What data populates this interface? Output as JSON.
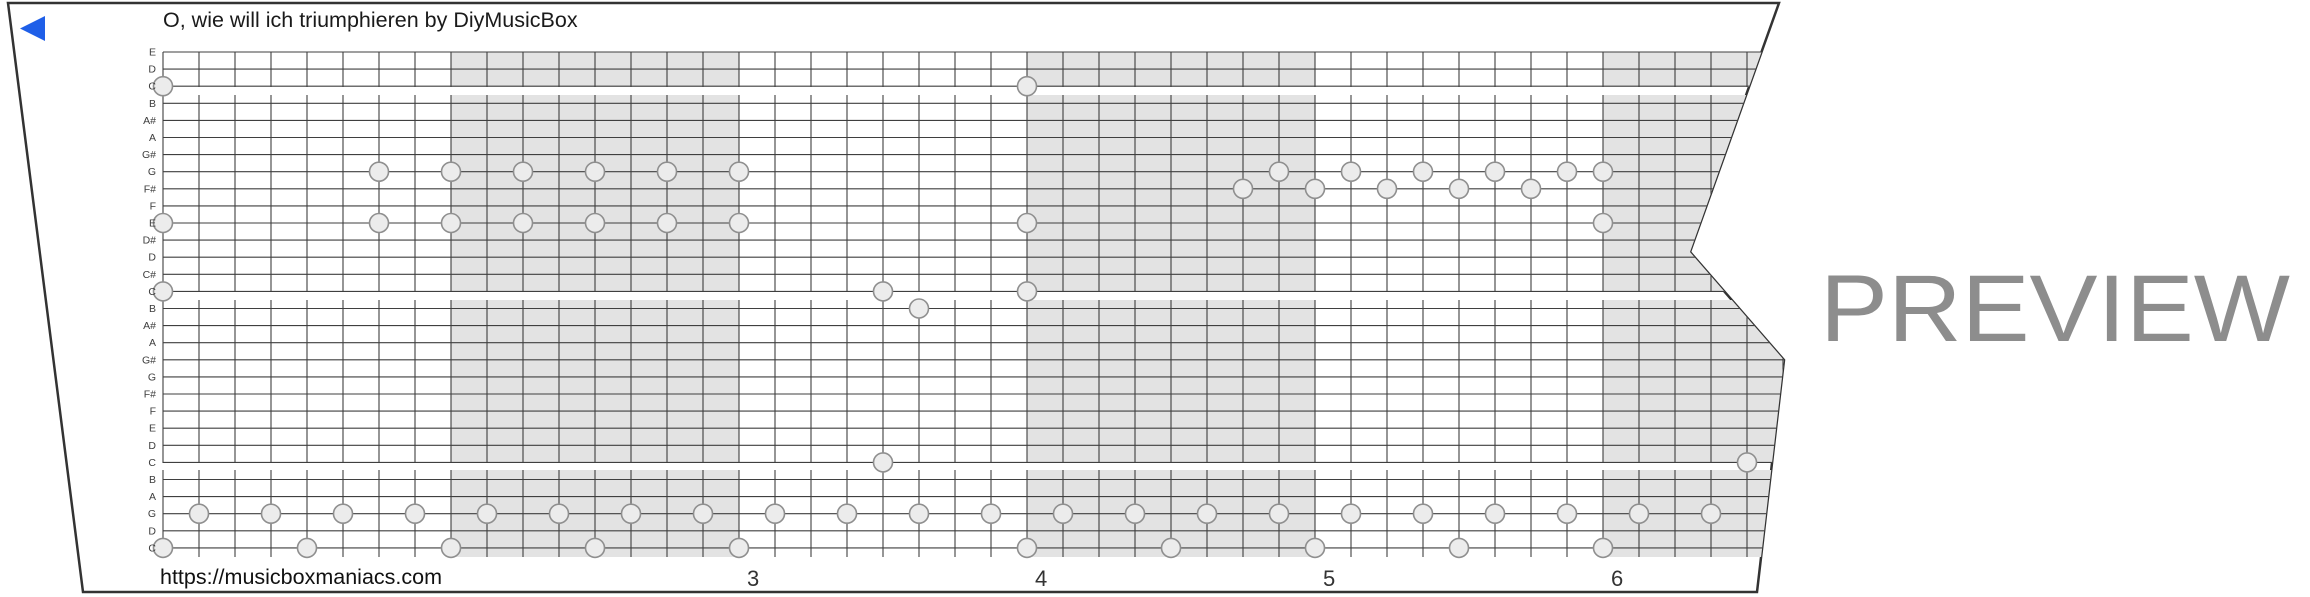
{
  "title": "O, wie will ich triumphieren by DiyMusicBox",
  "watermark": "PREVIEW",
  "footer_url": "https://musicboxmaniacs.com",
  "colors": {
    "background": "#ffffff",
    "strip_fill": "#ffffff",
    "strip_border": "#333333",
    "grid_line": "#3f3f3f",
    "measure_shade": "#e3e3e3",
    "note_fill": "#ececec",
    "note_stroke": "#8f8f8f",
    "label_text": "#3d3d3d",
    "number_text": "#333333",
    "title_text": "#1a1a1a",
    "url_text": "#111111",
    "watermark_text": "#8d8d8d",
    "play_arrow": "#1f5fe8"
  },
  "strip_outline": [
    [
      8,
      3
    ],
    [
      1779,
      3
    ],
    [
      1690,
      252
    ],
    [
      1784,
      360
    ],
    [
      1757,
      592
    ],
    [
      83,
      592
    ]
  ],
  "play_arrow_points": [
    [
      45,
      16
    ],
    [
      45,
      41
    ],
    [
      20,
      28.5
    ]
  ],
  "grid": {
    "x0": 163,
    "beat_width": 36,
    "row0_y": 52,
    "row_height": 17.1,
    "num_rows": 30,
    "num_beats": 46,
    "right_extent": 1800,
    "bands": [
      [
        52,
        87
      ],
      [
        95,
        292
      ],
      [
        300,
        463
      ],
      [
        470,
        557
      ]
    ],
    "row_labels": [
      "E",
      "D",
      "C",
      "B",
      "A#",
      "A",
      "G#",
      "G",
      "F#",
      "F",
      "E",
      "D#",
      "D",
      "C#",
      "C",
      "B",
      "A#",
      "A",
      "G#",
      "G",
      "F#",
      "F",
      "E",
      "D",
      "C",
      "B",
      "A",
      "G",
      "D",
      "C"
    ],
    "label_x": 156,
    "label_size": 10.5
  },
  "measures": {
    "beats_per_measure": 8,
    "shaded_measures": [
      2,
      4,
      6
    ],
    "numbers": [
      {
        "label": "3",
        "measure": 3
      },
      {
        "label": "4",
        "measure": 4
      },
      {
        "label": "5",
        "measure": 5
      },
      {
        "label": "6",
        "measure": 6
      }
    ],
    "number_y": 586,
    "number_size": 22,
    "number_x_offset": 8
  },
  "notes": [
    {
      "pitch": "C",
      "row": 3,
      "beats": [
        0,
        24
      ]
    },
    {
      "pitch": "G",
      "row": 8,
      "beats": [
        6,
        8,
        10,
        12,
        14,
        16,
        31,
        33,
        35,
        37,
        39,
        40
      ]
    },
    {
      "pitch": "F#",
      "row": 9,
      "beats": [
        30,
        32,
        34,
        36,
        38
      ]
    },
    {
      "pitch": "E",
      "row": 11,
      "beats": [
        0,
        6,
        8,
        10,
        12,
        14,
        16,
        24,
        40
      ]
    },
    {
      "pitch": "C",
      "row": 15,
      "beats": [
        0,
        20,
        24
      ]
    },
    {
      "pitch": "B",
      "row": 16,
      "beats": [
        21
      ]
    },
    {
      "pitch": "C",
      "row": 25,
      "beats": [
        20,
        44
      ]
    },
    {
      "pitch": "G",
      "row": 28,
      "beats": [
        1,
        3,
        5,
        7,
        9,
        11,
        13,
        15,
        17,
        19,
        21,
        23,
        25,
        27,
        29,
        31,
        33,
        35,
        37,
        39,
        41,
        43
      ]
    },
    {
      "pitch": "C",
      "row": 30,
      "beats": [
        0,
        4,
        8,
        12,
        16,
        24,
        28,
        32,
        36,
        40
      ]
    }
  ],
  "note_radius": 9.5,
  "layout": {
    "title_pos": [
      163,
      27
    ],
    "title_size": 21.5,
    "url_pos": [
      160,
      584
    ],
    "url_size": 21.5,
    "watermark": {
      "x": 1820,
      "y": 341,
      "size": 95,
      "length": 470
    }
  }
}
